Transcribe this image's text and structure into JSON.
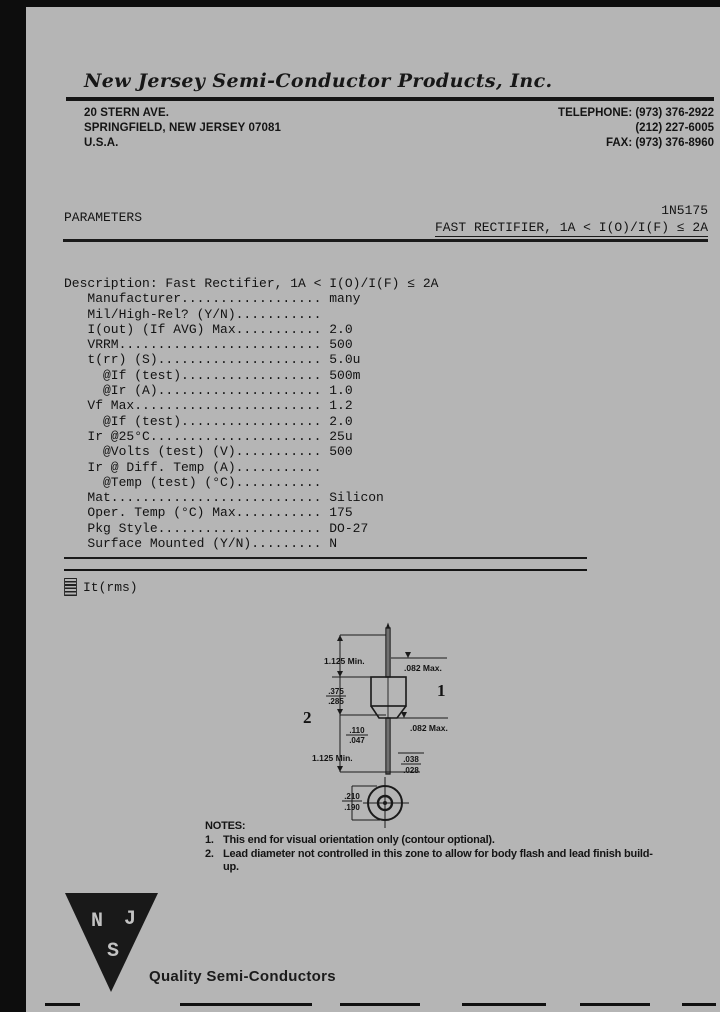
{
  "colors": {
    "paper": "#b5b5b5",
    "ink": "#141414",
    "scan_border": "#0d0d0d"
  },
  "header": {
    "company_name": "New Jersey Semi-Conductor Products, Inc.",
    "address_lines": [
      "20 STERN AVE.",
      "SPRINGFIELD, NEW JERSEY 07081",
      "U.S.A."
    ],
    "phone_line1": "TELEPHONE: (973) 376-2922",
    "phone_line2": "(212) 227-6005",
    "fax_line": "FAX: (973) 376-8960"
  },
  "title_block": {
    "section_label": "PARAMETERS",
    "part_number": "1N5175",
    "subtitle": "FAST RECTIFIER, 1A < I(O)/I(F) ≤ 2A"
  },
  "parameters": {
    "lines": [
      "Description: Fast Rectifier, 1A < I(O)/I(F) ≤ 2A",
      "   Manufacturer.................. many",
      "   Mil/High-Rel? (Y/N)...........",
      "   I(out) (If AVG) Max........... 2.0",
      "   VRRM.......................... 500",
      "   t(rr) (S)..................... 5.0u",
      "     @If (test).................. 500m",
      "     @Ir (A)..................... 1.0",
      "   Vf Max........................ 1.2",
      "     @If (test).................. 2.0",
      "   Ir @25°C...................... 25u",
      "     @Volts (test) (V)........... 500",
      "   Ir @ Diff. Temp (A)...........",
      "     @Temp (test) (°C)...........",
      "   Mat........................... Silicon",
      "   Oper. Temp (°C) Max........... 175",
      "   Pkg Style..................... DO-27",
      "   Surface Mounted (Y/N)......... N"
    ]
  },
  "footnote": {
    "text": "It(rms)",
    "marker_icon": "hatch-marker"
  },
  "package_drawing": {
    "callout_1": "1",
    "callout_2": "2",
    "top_lead_length": "1.125 Min.",
    "bottom_lead_length": "1.125 Min.",
    "upper_lead_dia": ".082 Max.",
    "lower_lead_dia": ".082 Max.",
    "body_length_num": ".375",
    "body_length_den": ".285",
    "zone_num": ".110",
    "zone_den": ".047",
    "lead_finish_num": ".038",
    "lead_finish_den": ".028",
    "end_view_num": ".210",
    "end_view_den": ".190"
  },
  "notes": {
    "heading": "NOTES:",
    "items": [
      {
        "num": "1.",
        "text": "This end for visual orientation only (contour optional)."
      },
      {
        "num": "2.",
        "text": "Lead diameter not controlled in this zone to allow for body flash and lead finish build-up."
      }
    ]
  },
  "logo": {
    "letter_top_left": "N",
    "letter_top_right": "J",
    "letter_bottom": "S",
    "tagline": "Quality Semi-Conductors"
  }
}
